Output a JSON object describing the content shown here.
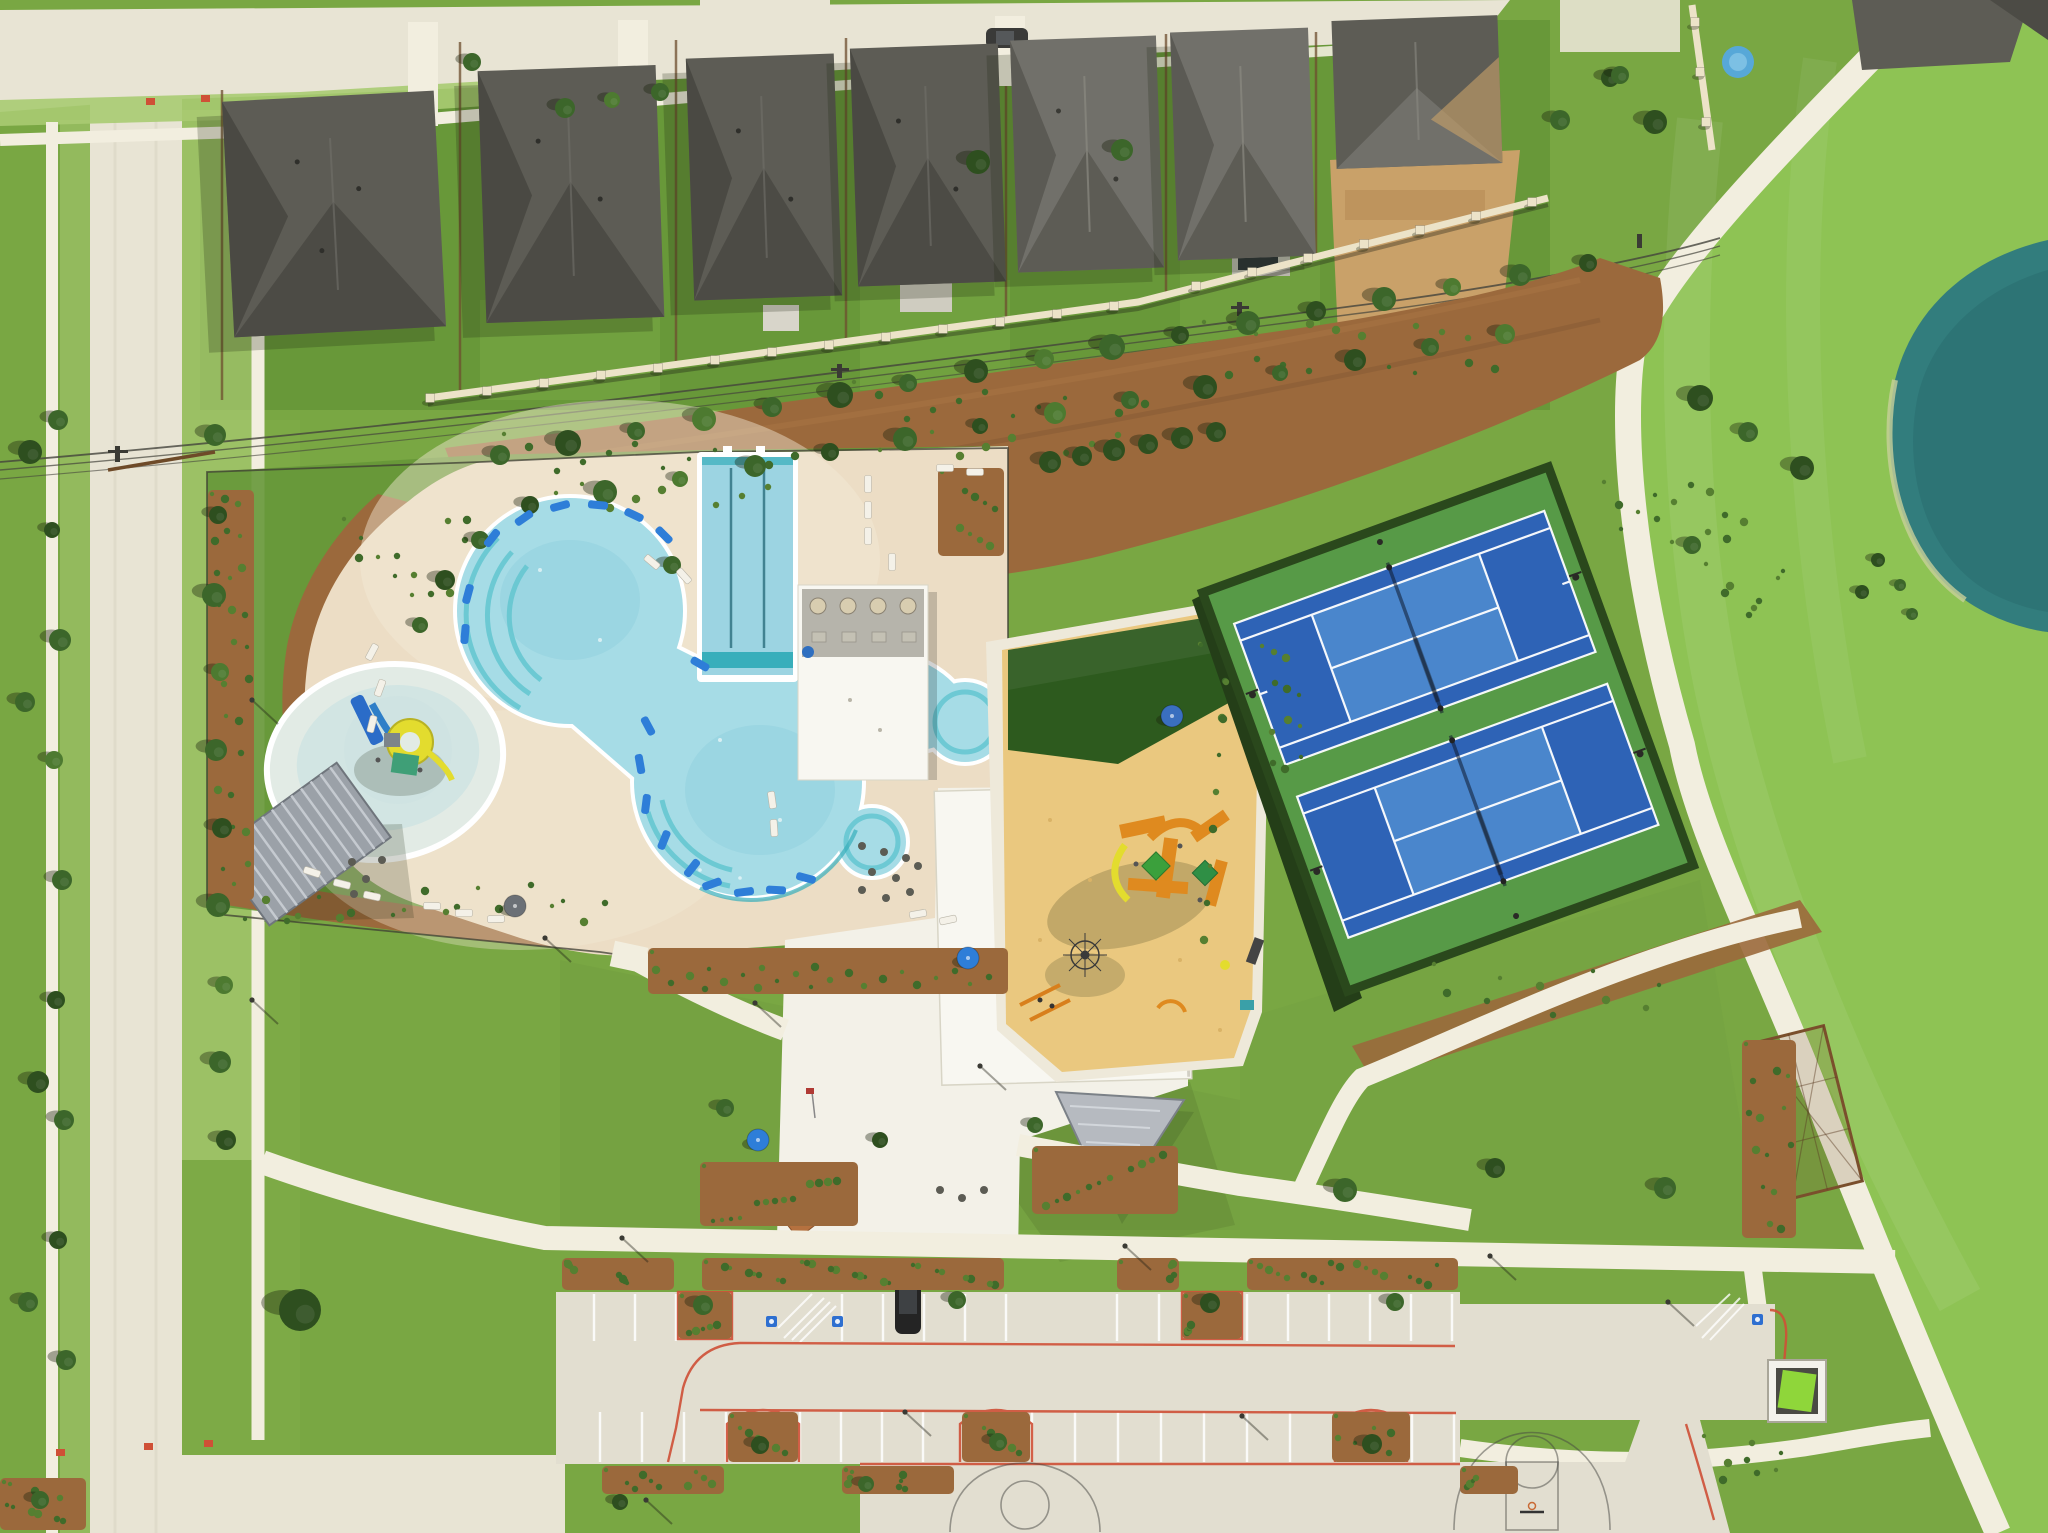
{
  "scene": {
    "type": "aerial-photo",
    "subject": "community amenity center with pool complex, playground, tennis courts, parking lot, homes and pond"
  },
  "colors": {
    "grass_base": "#79a743",
    "grass_back": "#669739",
    "grass_bright": "#8ec354",
    "grass_pale": "#b7d287",
    "verge": "#a9cb72",
    "road": "#e8e4d4",
    "slab": "#e2ded0",
    "sidewalk": "#f2eedf",
    "deck": "#ecddc5",
    "deck_light": "#f3ead8",
    "white_roof": "#f8f7f1",
    "sand": "#eac87f",
    "mulch": "#9b693c",
    "mulch_dark": "#7c5430",
    "dirt": "#c9a169",
    "roof_dark": "#4c4b45",
    "roof_facet": "#5d5c55",
    "roof_valley": "#3b3a35",
    "roof_light": "#71706a",
    "wall": "#ece3c8",
    "water": "#a6dce6",
    "water_lap": "#9cd4e2",
    "teal": "#38aebb",
    "teal_step": "#63c6d0",
    "kiddie": "#e2ebe5",
    "pond": "#327d7d",
    "pond_dark": "#2a6e6f",
    "turf": "#2d5a1e",
    "tennis_pad": "#579a47",
    "court": "#2e63b6",
    "court_in": "#4a86cc",
    "hedge": "#243e18",
    "bush1": "#3f6b2a",
    "bush2": "#567f31",
    "tree1": "#2e4f1f",
    "tree2": "#3c662a",
    "tree3": "#4d7a30",
    "shadow": "rgba(25,35,12,0.38)",
    "red_curb": "#cf5036",
    "blue": "#2e7ed8",
    "yellow": "#e3dc2e",
    "orange": "#df8a1f",
    "gray_roof": "#9ba1a8"
  },
  "features": {
    "trees": [
      [
        215,
        435,
        11,
        2
      ],
      [
        218,
        515,
        9,
        1
      ],
      [
        214,
        595,
        12,
        2
      ],
      [
        220,
        672,
        9,
        3
      ],
      [
        216,
        750,
        11,
        2
      ],
      [
        222,
        828,
        10,
        1
      ],
      [
        218,
        905,
        12,
        2
      ],
      [
        224,
        985,
        9,
        3
      ],
      [
        220,
        1062,
        11,
        2
      ],
      [
        226,
        1140,
        10,
        1
      ],
      [
        58,
        420,
        10,
        2
      ],
      [
        52,
        530,
        8,
        1
      ],
      [
        60,
        640,
        11,
        2
      ],
      [
        54,
        760,
        9,
        3
      ],
      [
        62,
        880,
        10,
        2
      ],
      [
        56,
        1000,
        9,
        1
      ],
      [
        64,
        1120,
        10,
        2
      ],
      [
        58,
        1240,
        9,
        1
      ],
      [
        66,
        1360,
        10,
        2
      ],
      [
        30,
        452,
        12,
        1
      ],
      [
        25,
        702,
        10,
        2
      ],
      [
        38,
        1082,
        11,
        1
      ],
      [
        28,
        1302,
        10,
        2
      ],
      [
        565,
        108,
        10,
        2
      ],
      [
        612,
        100,
        8,
        3
      ],
      [
        660,
        92,
        9,
        2
      ],
      [
        472,
        62,
        9,
        2
      ],
      [
        978,
        162,
        12,
        1
      ],
      [
        1122,
        150,
        11,
        2
      ],
      [
        1560,
        120,
        10,
        2
      ],
      [
        1610,
        78,
        9,
        1
      ],
      [
        500,
        455,
        10,
        2
      ],
      [
        568,
        443,
        13,
        1
      ],
      [
        636,
        431,
        9,
        2
      ],
      [
        704,
        419,
        12,
        3
      ],
      [
        772,
        407,
        10,
        2
      ],
      [
        840,
        395,
        13,
        1
      ],
      [
        908,
        383,
        9,
        2
      ],
      [
        976,
        371,
        12,
        1
      ],
      [
        1044,
        359,
        10,
        3
      ],
      [
        1112,
        347,
        13,
        2
      ],
      [
        1180,
        335,
        9,
        1
      ],
      [
        1248,
        323,
        12,
        2
      ],
      [
        1316,
        311,
        10,
        1
      ],
      [
        1384,
        299,
        12,
        2
      ],
      [
        1452,
        287,
        9,
        3
      ],
      [
        1520,
        275,
        11,
        2
      ],
      [
        1588,
        263,
        9,
        1
      ],
      [
        530,
        505,
        9,
        1
      ],
      [
        605,
        492,
        12,
        2
      ],
      [
        680,
        479,
        8,
        3
      ],
      [
        755,
        466,
        11,
        2
      ],
      [
        830,
        452,
        9,
        1
      ],
      [
        905,
        439,
        12,
        2
      ],
      [
        980,
        426,
        8,
        1
      ],
      [
        1055,
        413,
        11,
        3
      ],
      [
        1130,
        400,
        9,
        2
      ],
      [
        1205,
        387,
        12,
        1
      ],
      [
        1280,
        373,
        8,
        2
      ],
      [
        1355,
        360,
        11,
        1
      ],
      [
        1430,
        347,
        9,
        2
      ],
      [
        1505,
        334,
        10,
        3
      ],
      [
        480,
        540,
        9,
        2
      ],
      [
        445,
        580,
        10,
        1
      ],
      [
        420,
        625,
        8,
        2
      ],
      [
        1050,
        462,
        11,
        1
      ],
      [
        1082,
        456,
        10,
        1
      ],
      [
        1114,
        450,
        11,
        1
      ],
      [
        1148,
        444,
        10,
        1
      ],
      [
        1182,
        438,
        11,
        1
      ],
      [
        1216,
        432,
        10,
        1
      ],
      [
        1345,
        1190,
        12,
        2
      ],
      [
        1495,
        1168,
        10,
        1
      ],
      [
        1665,
        1188,
        11,
        2
      ],
      [
        725,
        1108,
        9,
        2
      ],
      [
        880,
        1140,
        8,
        1
      ],
      [
        1035,
        1125,
        8,
        2
      ],
      [
        300,
        1310,
        21,
        1
      ],
      [
        672,
        565,
        9,
        2
      ],
      [
        1700,
        398,
        13,
        1
      ],
      [
        1748,
        432,
        10,
        2
      ],
      [
        1802,
        468,
        12,
        1
      ],
      [
        1692,
        545,
        9,
        2
      ],
      [
        1862,
        592,
        7,
        1
      ],
      [
        1912,
        614,
        6,
        2
      ],
      [
        1655,
        122,
        12,
        1
      ],
      [
        1620,
        75,
        9,
        2
      ],
      [
        1878,
        560,
        7,
        1
      ],
      [
        1900,
        585,
        6,
        2
      ],
      [
        703,
        1305,
        10,
        2
      ],
      [
        957,
        1300,
        9,
        2
      ],
      [
        1210,
        1303,
        10,
        1
      ],
      [
        1395,
        1302,
        9,
        2
      ],
      [
        760,
        1445,
        9,
        1
      ],
      [
        998,
        1442,
        9,
        2
      ],
      [
        1372,
        1444,
        10,
        1
      ],
      [
        866,
        1484,
        8,
        2
      ],
      [
        620,
        1502,
        8,
        1
      ],
      [
        40,
        1500,
        9,
        2
      ]
    ],
    "beds": [
      [
        208,
        490,
        46,
        410,
        26,
        1
      ],
      [
        340,
        515,
        150,
        100,
        14,
        0
      ],
      [
        230,
        880,
        400,
        48,
        22,
        0
      ],
      [
        648,
        948,
        360,
        46,
        24,
        1
      ],
      [
        500,
        430,
        300,
        85,
        20,
        0
      ],
      [
        850,
        378,
        300,
        85,
        20,
        0
      ],
      [
        1200,
        318,
        300,
        80,
        18,
        0
      ],
      [
        1600,
        478,
        150,
        72,
        14,
        0
      ],
      [
        1702,
        560,
        90,
        60,
        8,
        0
      ],
      [
        1430,
        960,
        260,
        60,
        10,
        0
      ],
      [
        1258,
        642,
        48,
        150,
        12,
        0
      ],
      [
        562,
        1258,
        112,
        32,
        10,
        1
      ],
      [
        702,
        1258,
        302,
        32,
        26,
        1
      ],
      [
        1117,
        1258,
        62,
        32,
        6,
        1
      ],
      [
        1247,
        1258,
        211,
        32,
        18,
        1
      ],
      [
        602,
        1466,
        122,
        28,
        10,
        1
      ],
      [
        842,
        1466,
        112,
        28,
        8,
        1
      ],
      [
        1460,
        1466,
        58,
        28,
        5,
        1
      ],
      [
        728,
        1412,
        70,
        50,
        7,
        1
      ],
      [
        962,
        1412,
        68,
        50,
        7,
        1
      ],
      [
        1332,
        1412,
        78,
        50,
        7,
        1
      ],
      [
        678,
        1292,
        54,
        47,
        6,
        1
      ],
      [
        1182,
        1292,
        60,
        47,
        6,
        1
      ],
      [
        700,
        1162,
        158,
        64,
        14,
        1
      ],
      [
        1032,
        1146,
        146,
        68,
        12,
        1
      ],
      [
        0,
        1478,
        86,
        52,
        10,
        1
      ],
      [
        1742,
        1040,
        54,
        198,
        14,
        1
      ],
      [
        1700,
        1432,
        90,
        55,
        8,
        0
      ],
      [
        938,
        468,
        66,
        88,
        9,
        1
      ],
      [
        1196,
        640,
        36,
        340,
        12,
        0
      ]
    ],
    "stalls": [
      [
        594,
        676,
        1294,
        47,
        41
      ],
      [
        842,
        1006,
        1294,
        47,
        41
      ],
      [
        1117,
        1181,
        1294,
        47,
        42
      ],
      [
        1247,
        1452,
        1294,
        47,
        41
      ],
      [
        600,
        726,
        1412,
        50,
        42
      ],
      [
        800,
        962,
        1412,
        50,
        41
      ],
      [
        1032,
        1332,
        1412,
        50,
        43
      ],
      [
        1412,
        1456,
        1412,
        50,
        42
      ]
    ],
    "loungers": [
      [
        492,
        538,
        -52
      ],
      [
        524,
        518,
        -35
      ],
      [
        560,
        506,
        -15
      ],
      [
        598,
        505,
        5
      ],
      [
        634,
        515,
        25
      ],
      [
        664,
        535,
        45
      ],
      [
        468,
        594,
        -75
      ],
      [
        465,
        634,
        -85
      ],
      [
        648,
        726,
        62
      ],
      [
        640,
        764,
        80
      ],
      [
        646,
        804,
        97
      ],
      [
        664,
        840,
        112
      ],
      [
        692,
        868,
        128
      ],
      [
        712,
        884,
        160
      ],
      [
        744,
        892,
        172
      ],
      [
        776,
        890,
        183
      ],
      [
        806,
        878,
        195
      ],
      [
        700,
        664,
        30
      ]
    ],
    "chairs": [
      [
        868,
        484,
        90
      ],
      [
        868,
        510,
        90
      ],
      [
        868,
        536,
        90
      ],
      [
        892,
        562,
        90
      ],
      [
        652,
        562,
        40
      ],
      [
        684,
        576,
        48
      ],
      [
        372,
        652,
        -62
      ],
      [
        380,
        688,
        -70
      ],
      [
        372,
        724,
        -76
      ],
      [
        312,
        872,
        18
      ],
      [
        342,
        884,
        14
      ],
      [
        372,
        896,
        12
      ],
      [
        432,
        906,
        2
      ],
      [
        464,
        913,
        0
      ],
      [
        496,
        919,
        -2
      ],
      [
        772,
        800,
        82
      ],
      [
        774,
        828,
        86
      ],
      [
        945,
        468,
        0
      ],
      [
        975,
        472,
        0
      ],
      [
        918,
        914,
        -10
      ],
      [
        948,
        920,
        -12
      ]
    ],
    "wallposts": [
      [
        430,
        398
      ],
      [
        487,
        391
      ],
      [
        544,
        383
      ],
      [
        601,
        375
      ],
      [
        658,
        368
      ],
      [
        715,
        360
      ],
      [
        772,
        352
      ],
      [
        829,
        345
      ],
      [
        886,
        337
      ],
      [
        943,
        329
      ],
      [
        1000,
        322
      ],
      [
        1057,
        314
      ],
      [
        1114,
        306
      ],
      [
        1196,
        286
      ],
      [
        1252,
        272
      ],
      [
        1308,
        258
      ],
      [
        1364,
        244
      ],
      [
        1420,
        230
      ],
      [
        1476,
        216
      ],
      [
        1532,
        202
      ],
      [
        1695,
        22
      ],
      [
        1700,
        72
      ],
      [
        1706,
        122
      ]
    ],
    "furniture": [
      [
        862,
        846
      ],
      [
        884,
        852
      ],
      [
        906,
        858
      ],
      [
        872,
        872
      ],
      [
        896,
        878
      ],
      [
        918,
        866
      ],
      [
        862,
        890
      ],
      [
        886,
        898
      ],
      [
        910,
        892
      ],
      [
        940,
        1190
      ],
      [
        962,
        1198
      ],
      [
        984,
        1190
      ],
      [
        352,
        862
      ],
      [
        366,
        879
      ],
      [
        382,
        860
      ],
      [
        354,
        894
      ]
    ],
    "poles": [
      [
        622,
        1238
      ],
      [
        1125,
        1246
      ],
      [
        1490,
        1256
      ],
      [
        905,
        1412
      ],
      [
        1242,
        1416
      ],
      [
        646,
        1500
      ],
      [
        1668,
        1302
      ],
      [
        755,
        1003
      ],
      [
        980,
        1066
      ],
      [
        545,
        938
      ],
      [
        252,
        700
      ],
      [
        252,
        1000
      ]
    ],
    "umbrellas": [
      [
        758,
        1140,
        "#2e7ed8"
      ],
      [
        968,
        958,
        "#2e7ed8"
      ],
      [
        515,
        906,
        "#6b7076"
      ],
      [
        1172,
        716,
        "#3a6fbf"
      ]
    ]
  }
}
